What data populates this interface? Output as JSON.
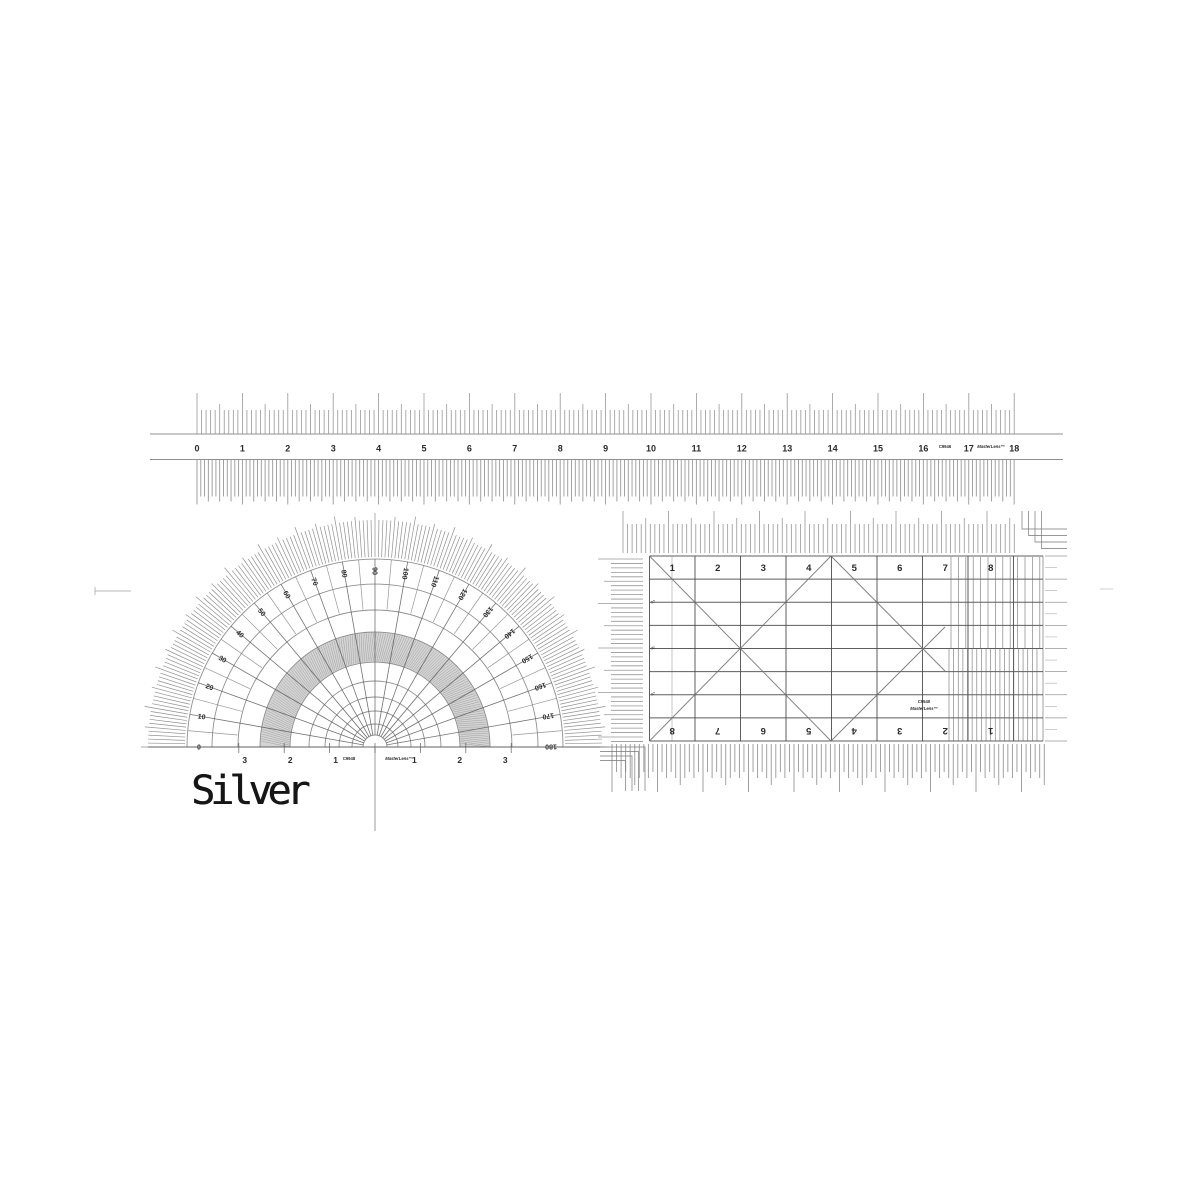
{
  "colors": {
    "line": "#5a5a5a",
    "line_soft": "#7d7d7d",
    "line_faint": "#9a9a9a",
    "label": "#2b2b2b",
    "band_fill": "#c9c9c9",
    "band_hatch": "#949494",
    "background": "#ffffff",
    "silver_text": "#161616"
  },
  "silver_label": {
    "text": "Silver"
  },
  "ruler": {
    "title": "18 inch ruler",
    "unit_labels": [
      "0",
      "1",
      "2",
      "3",
      "4",
      "5",
      "6",
      "7",
      "8",
      "9",
      "10",
      "11",
      "12",
      "13",
      "14",
      "15",
      "16",
      "17",
      "18"
    ],
    "code": "C9946",
    "brand": "MasterLens™"
  },
  "protractor": {
    "title": "semicircular protractor",
    "degree_labels": [
      "0",
      "10",
      "20",
      "30",
      "40",
      "50",
      "60",
      "70",
      "80",
      "90",
      "100",
      "110",
      "120",
      "130",
      "140",
      "150",
      "160",
      "170",
      "180"
    ],
    "base_scale_left": [
      "3",
      "2",
      "1"
    ],
    "base_scale_right": [
      "1",
      "2",
      "3"
    ],
    "code": "C9948",
    "brand": "MasterLens™"
  },
  "grid_ruler": {
    "title": "rectangular grid ruler",
    "top_labels": [
      "1",
      "2",
      "3",
      "4",
      "5",
      "6",
      "7",
      "8"
    ],
    "bottom_labels": [
      "8",
      "7",
      "6",
      "5",
      "4",
      "3",
      "2",
      "1"
    ],
    "side_labels": [
      "¼",
      "½",
      "¾"
    ],
    "code": "C9540",
    "brand": "MasterLens™"
  }
}
